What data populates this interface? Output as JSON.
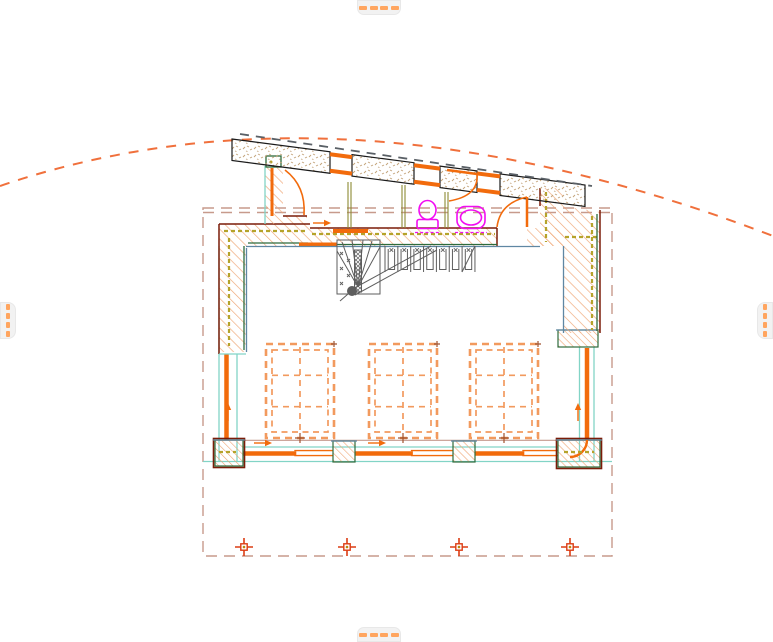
{
  "app": {
    "type": "cad-floor-plan-viewport",
    "visible_text": ""
  },
  "colors": {
    "background": "#FFFFFF",
    "accent": "#F26B0C",
    "accent_light": "#F29A5E",
    "curve_orange": "#F0703C",
    "hatch": "#EFA573",
    "stipple": "#C2A177",
    "band_outline": "#1A1A1A",
    "dark_red": "#7A1C08",
    "dark_green": "#2E6B3C",
    "teal": "#82D4C6",
    "steel": "#5F87A3",
    "olive": "#B5A32A",
    "olive_dark": "#8C8A33",
    "gray_stair": "#5E5E5E",
    "gray_dash": "#5A6066",
    "magenta": "#F20CF2",
    "rosy": "#C79A8C",
    "rosy_solid": "#C49A8E",
    "marker_red": "#DC3D14",
    "marker_gold": "#B8860B",
    "brown": "#A0522D",
    "handle_bg": "#F2F2F2",
    "handle_dash": "#FFA55F"
  },
  "handles": {
    "items": [
      {
        "id": "top",
        "orientation": "horizontal",
        "dashes": 4
      },
      {
        "id": "bottom",
        "orientation": "horizontal",
        "dashes": 4
      },
      {
        "id": "left",
        "orientation": "vertical",
        "dashes": 4
      },
      {
        "id": "right",
        "orientation": "vertical",
        "dashes": 4
      }
    ]
  },
  "drawing": {
    "roof_band": {
      "x0": 232,
      "y0": 139,
      "slope": 0.1303,
      "thickness": 21.5,
      "segments": [
        [
          232,
          330
        ],
        [
          352,
          414
        ],
        [
          440,
          477
        ],
        [
          500,
          585
        ]
      ],
      "windows": [
        [
          330,
          352
        ],
        [
          414,
          440
        ],
        [
          477,
          500
        ]
      ]
    },
    "eave_curve_path": "M0,186 Q340,70 773,236",
    "trace_rect": {
      "x": 203,
      "y": 208,
      "w": 409,
      "h": 348
    },
    "skylights": {
      "y": 344,
      "w": 68,
      "h": 94,
      "inset": 6,
      "x_positions": [
        266,
        369,
        470
      ],
      "grid": "2x3"
    },
    "markers": {
      "y": 547,
      "x_positions": [
        244,
        347,
        459,
        570
      ]
    },
    "piers": [
      {
        "x": 215,
        "y": 440,
        "w": 28,
        "h": 26,
        "corner": true
      },
      {
        "x": 333,
        "y": 441,
        "w": 22,
        "h": 21,
        "corner": false
      },
      {
        "x": 453,
        "y": 441,
        "w": 22,
        "h": 21,
        "corner": false
      },
      {
        "x": 558,
        "y": 440,
        "w": 42,
        "h": 27,
        "corner": true
      },
      {
        "x": 558,
        "y": 330,
        "w": 40,
        "h": 17,
        "corner": false
      }
    ],
    "posts": [
      [
        348,
        182,
        228
      ],
      [
        402,
        185,
        228
      ],
      [
        445,
        192,
        228
      ]
    ],
    "glazing_bays": [
      [
        243,
        333
      ],
      [
        355,
        453
      ],
      [
        475,
        558
      ]
    ],
    "arrows": [
      {
        "x": 263,
        "y": 443,
        "dir": "right"
      },
      {
        "x": 377,
        "y": 443,
        "dir": "right"
      },
      {
        "x": 322,
        "y": 223,
        "dir": "right"
      },
      {
        "x": 228,
        "y": 412,
        "dir": "up"
      },
      {
        "x": 578,
        "y": 412,
        "dir": "up"
      }
    ],
    "stair": {
      "treads": 8,
      "x0": 385,
      "dx": 12.85,
      "y_top": 246,
      "y_bot": 272
    },
    "fixtures": [
      "toilet",
      "bidet"
    ]
  }
}
